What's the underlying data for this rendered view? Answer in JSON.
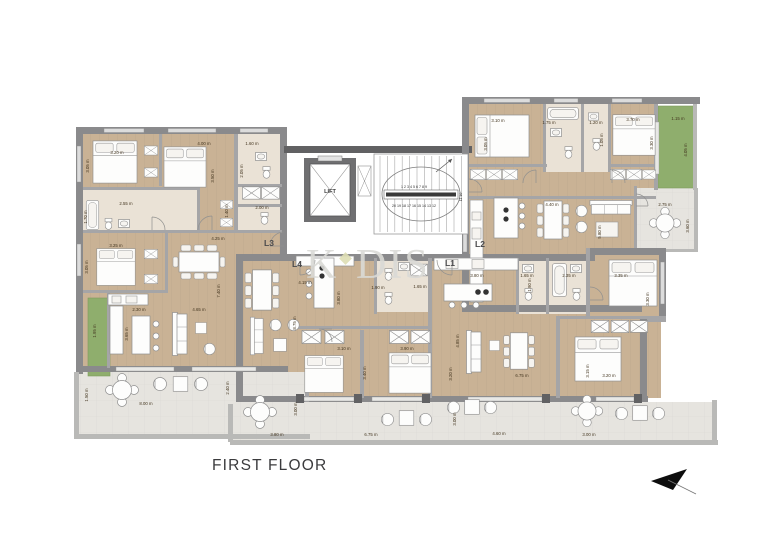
{
  "title": {
    "text": "FIRST FLOOR"
  },
  "watermark": {
    "k": "K",
    "dis": "DIS"
  },
  "core": {
    "lift_label": "LIFT",
    "stairs": {
      "top_numbers": "1 2 3 4 5 6 7 8 9",
      "bottom_numbers": "20 19 18 17 16 15 14 13 12",
      "side_numbers": "11 10"
    }
  },
  "unit_labels": [
    {
      "id": "unit-l3",
      "text": "L3",
      "x": 269,
      "y": 246
    },
    {
      "id": "unit-l4",
      "text": "L4",
      "x": 297,
      "y": 267
    },
    {
      "id": "unit-l2",
      "text": "L2",
      "x": 480,
      "y": 247
    },
    {
      "id": "unit-l1",
      "text": "L1",
      "x": 450,
      "y": 266
    }
  ],
  "dimensions": [
    {
      "t": "3.20 m",
      "x": 117,
      "y": 154
    },
    {
      "t": "4.00 m",
      "x": 204,
      "y": 145
    },
    {
      "t": "1.60 m",
      "x": 252,
      "y": 145
    },
    {
      "t": "3.05 m",
      "x": 89,
      "y": 166,
      "v": true
    },
    {
      "t": "3.50 m",
      "x": 214,
      "y": 176,
      "v": true
    },
    {
      "t": "2.05 m",
      "x": 243,
      "y": 171,
      "v": true
    },
    {
      "t": "2.55 m",
      "x": 126,
      "y": 205
    },
    {
      "t": "1.70 m",
      "x": 87,
      "y": 217,
      "v": true
    },
    {
      "t": "1.40 m",
      "x": 228,
      "y": 211,
      "v": true
    },
    {
      "t": "2.00 m",
      "x": 262,
      "y": 209
    },
    {
      "t": "4.25 m",
      "x": 218,
      "y": 240
    },
    {
      "t": "3.25 m",
      "x": 116,
      "y": 247
    },
    {
      "t": "3.05 m",
      "x": 88,
      "y": 267,
      "v": true
    },
    {
      "t": "7.40 m",
      "x": 220,
      "y": 291,
      "v": true
    },
    {
      "t": "2.30 m",
      "x": 139,
      "y": 311
    },
    {
      "t": "4.65 m",
      "x": 199,
      "y": 311
    },
    {
      "t": "1.95 m",
      "x": 96,
      "y": 331,
      "v": true
    },
    {
      "t": "3.65 m",
      "x": 128,
      "y": 334,
      "v": true
    },
    {
      "t": "1.50 m",
      "x": 88,
      "y": 395,
      "v": true
    },
    {
      "t": "8.00 m",
      "x": 146,
      "y": 405
    },
    {
      "t": "2.40 m",
      "x": 229,
      "y": 388,
      "v": true
    },
    {
      "t": "3.10 m",
      "x": 498,
      "y": 122
    },
    {
      "t": "3.05 m",
      "x": 487,
      "y": 144,
      "v": true
    },
    {
      "t": "1.75 m",
      "x": 549,
      "y": 124
    },
    {
      "t": "1.20 m",
      "x": 596,
      "y": 124
    },
    {
      "t": "1.05 m",
      "x": 603,
      "y": 140,
      "v": true
    },
    {
      "t": "3.70 m",
      "x": 633,
      "y": 121
    },
    {
      "t": "3.30 m",
      "x": 653,
      "y": 143,
      "v": true
    },
    {
      "t": "1.15 m",
      "x": 678,
      "y": 120
    },
    {
      "t": "4.05 m",
      "x": 687,
      "y": 150,
      "v": true
    },
    {
      "t": "4.40 m",
      "x": 552,
      "y": 206
    },
    {
      "t": "5.80 m",
      "x": 601,
      "y": 232,
      "v": true
    },
    {
      "t": "2.75 m",
      "x": 665,
      "y": 206
    },
    {
      "t": "3.60 m",
      "x": 689,
      "y": 226,
      "v": true
    },
    {
      "t": "4.15 m",
      "x": 305,
      "y": 284
    },
    {
      "t": "3.80 m",
      "x": 340,
      "y": 298,
      "v": true
    },
    {
      "t": "8.75 m",
      "x": 296,
      "y": 323,
      "v": true
    },
    {
      "t": "1.90 m",
      "x": 378,
      "y": 289
    },
    {
      "t": "1.65 m",
      "x": 420,
      "y": 288
    },
    {
      "t": "3.10 m",
      "x": 344,
      "y": 350
    },
    {
      "t": "3.90 m",
      "x": 407,
      "y": 350
    },
    {
      "t": "3.40 m",
      "x": 366,
      "y": 373,
      "v": true
    },
    {
      "t": "3.20 m",
      "x": 452,
      "y": 374,
      "v": true
    },
    {
      "t": "3.80 m",
      "x": 477,
      "y": 277
    },
    {
      "t": "1.65 m",
      "x": 527,
      "y": 277
    },
    {
      "t": "2.35 m",
      "x": 569,
      "y": 277
    },
    {
      "t": "3.35 m",
      "x": 621,
      "y": 277
    },
    {
      "t": "1.90 m",
      "x": 531,
      "y": 285,
      "v": true
    },
    {
      "t": "3.30 m",
      "x": 649,
      "y": 299,
      "v": true
    },
    {
      "t": "4.85 m",
      "x": 459,
      "y": 341,
      "v": true
    },
    {
      "t": "6.75 m",
      "x": 522,
      "y": 377
    },
    {
      "t": "3.15 m",
      "x": 589,
      "y": 371,
      "v": true
    },
    {
      "t": "3.20 m",
      "x": 609,
      "y": 377
    },
    {
      "t": "3.80 m",
      "x": 277,
      "y": 436
    },
    {
      "t": "3.00 m",
      "x": 297,
      "y": 409,
      "v": true
    },
    {
      "t": "6.75 m",
      "x": 371,
      "y": 436
    },
    {
      "t": "3.00 m",
      "x": 456,
      "y": 419,
      "v": true
    },
    {
      "t": "4.60 m",
      "x": 499,
      "y": 435
    },
    {
      "t": "3.00 m",
      "x": 589,
      "y": 436
    }
  ],
  "colors": {
    "wood_floor": "#c9b295",
    "bath_floor": "#eae2d6",
    "balcony_floor": "#e6e4df",
    "green_area": "#8fae6d",
    "wall": "#8a8a8c",
    "wall_dark": "#616163",
    "dimension_text": "#43351f"
  }
}
